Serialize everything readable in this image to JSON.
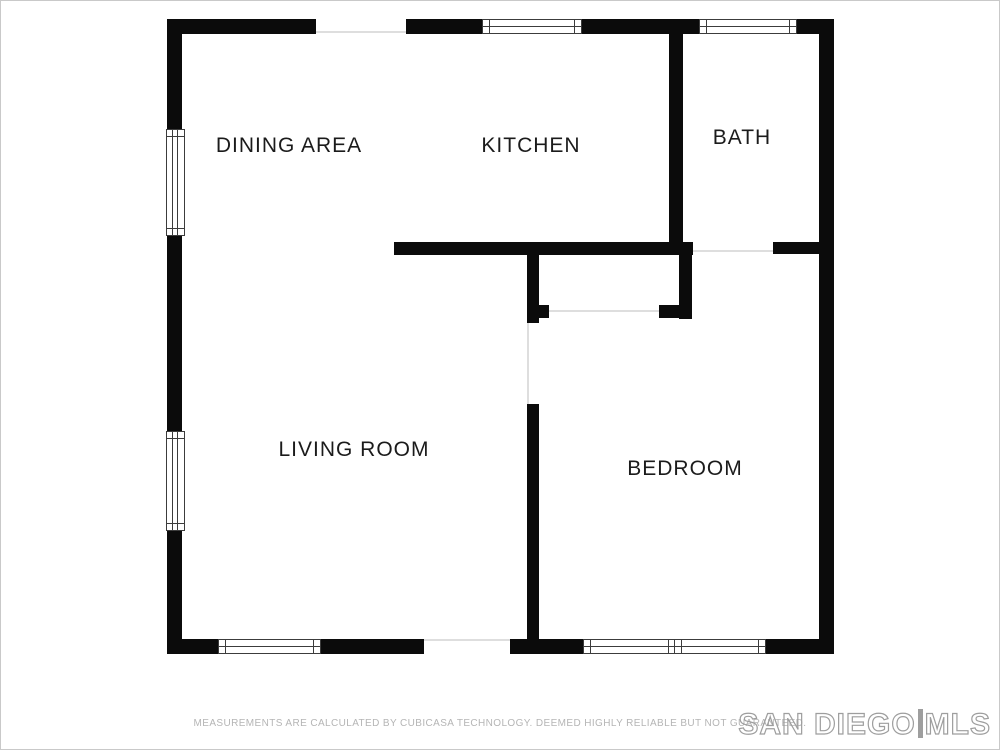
{
  "colors": {
    "wall": "#0b0b0b",
    "frame": "#3c3c3c",
    "faint": "#dedede",
    "label": "#1b1b1b",
    "footer": "#b5b5b5",
    "logo": "#9e9e9e"
  },
  "rooms": [
    {
      "id": "dining-area",
      "label": "DINING AREA"
    },
    {
      "id": "kitchen",
      "label": "KITCHEN"
    },
    {
      "id": "bath",
      "label": "BATH"
    },
    {
      "id": "living-room",
      "label": "LIVING ROOM"
    },
    {
      "id": "bedroom",
      "label": "BEDROOM"
    }
  ],
  "footer": {
    "disclaimer": "MEASUREMENTS ARE CALCULATED BY CUBICASA TECHNOLOGY. DEEMED HIGHLY RELIABLE BUT NOT GUARANTEED."
  },
  "logo": {
    "part1": "SAN DIEGO",
    "separator": "|",
    "part2": "MLS"
  }
}
